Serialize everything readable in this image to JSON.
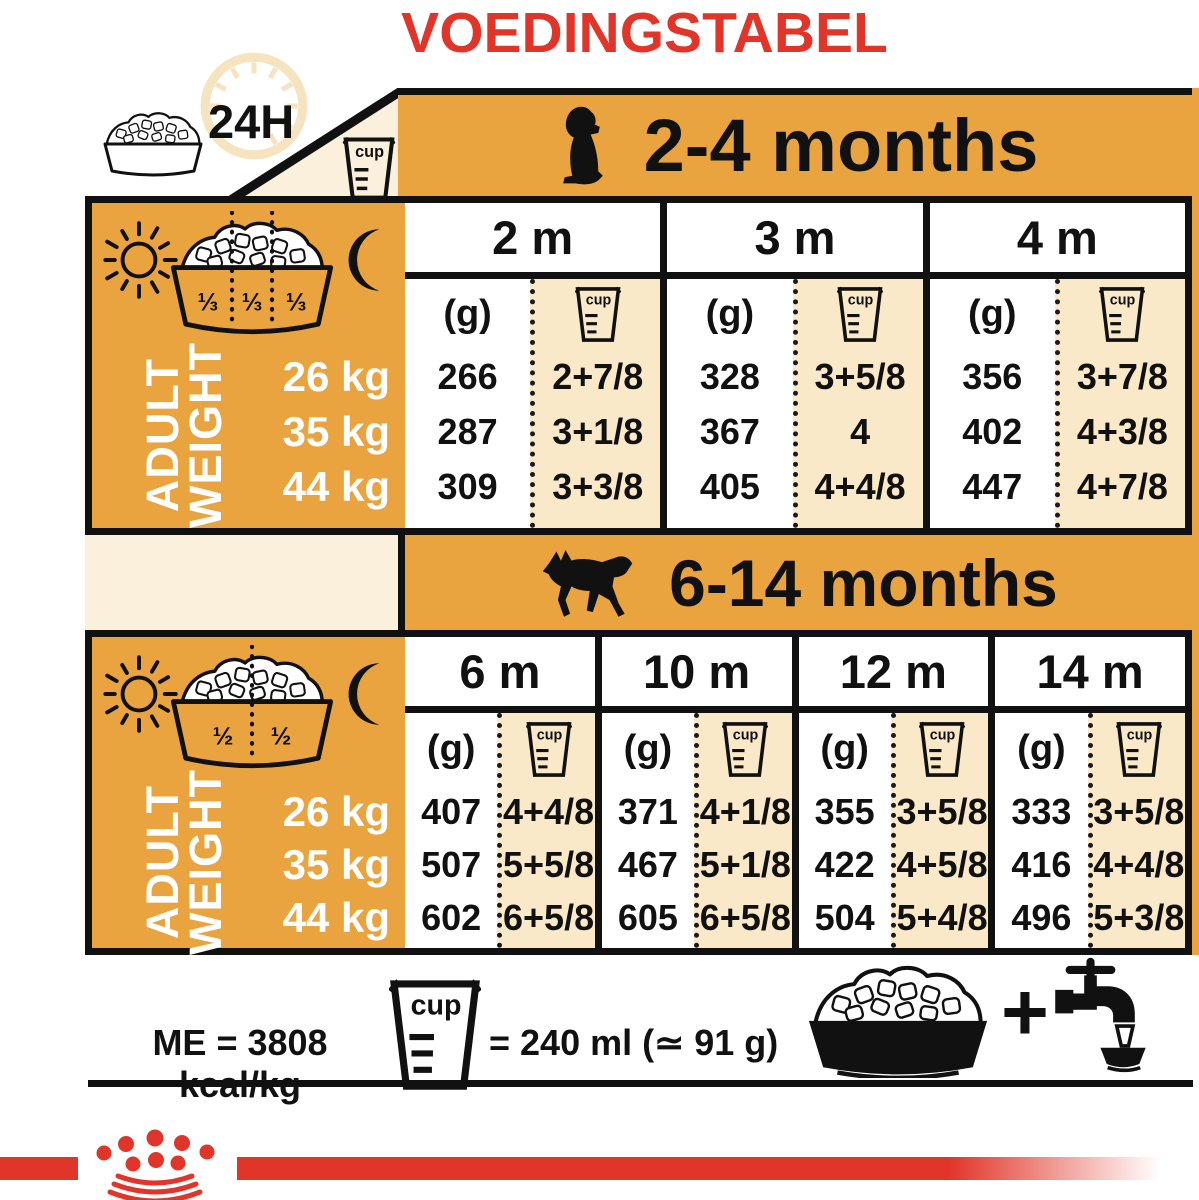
{
  "title": "VOEDINGSTABEL",
  "colors": {
    "red": "#E1352A",
    "orange": "#E9A440",
    "cream": "#FAE9C9",
    "cream_light": "#FAF0DC",
    "black": "#111111"
  },
  "top_left": {
    "label_24h": "24H"
  },
  "cup_label": "cup",
  "gram_label": "(g)",
  "adult_weight": {
    "line1": "ADULT",
    "line2": "WEIGHT"
  },
  "tables": [
    {
      "age_range": "2-4 months",
      "bowl_fractions": [
        "⅓",
        "⅓",
        "⅓"
      ],
      "weights": [
        "26 kg",
        "35 kg",
        "44 kg"
      ],
      "columns": [
        {
          "month": "2 m",
          "grams": [
            "266",
            "287",
            "309"
          ],
          "cups": [
            "2+7/8",
            "3+1/8",
            "3+3/8"
          ]
        },
        {
          "month": "3 m",
          "grams": [
            "328",
            "367",
            "405"
          ],
          "cups": [
            "3+5/8",
            "4",
            "4+4/8"
          ]
        },
        {
          "month": "4 m",
          "grams": [
            "356",
            "402",
            "447"
          ],
          "cups": [
            "3+7/8",
            "4+3/8",
            "4+7/8"
          ]
        }
      ]
    },
    {
      "age_range": "6-14 months",
      "bowl_fractions": [
        "½",
        "½"
      ],
      "weights": [
        "26 kg",
        "35 kg",
        "44 kg"
      ],
      "columns": [
        {
          "month": "6 m",
          "grams": [
            "407",
            "507",
            "602"
          ],
          "cups": [
            "4+4/8",
            "5+5/8",
            "6+5/8"
          ]
        },
        {
          "month": "10 m",
          "grams": [
            "371",
            "467",
            "605"
          ],
          "cups": [
            "4+1/8",
            "5+1/8",
            "6+5/8"
          ]
        },
        {
          "month": "12 m",
          "grams": [
            "355",
            "422",
            "504"
          ],
          "cups": [
            "3+5/8",
            "4+5/8",
            "5+4/8"
          ]
        },
        {
          "month": "14 m",
          "grams": [
            "333",
            "416",
            "496"
          ],
          "cups": [
            "3+5/8",
            "4+4/8",
            "5+3/8"
          ]
        }
      ]
    }
  ],
  "footer": {
    "me_text": "ME = 3808 kcal/kg",
    "cup_equivalence": "= 240 ml (≃ 91 g)",
    "plus_sign": "+"
  }
}
